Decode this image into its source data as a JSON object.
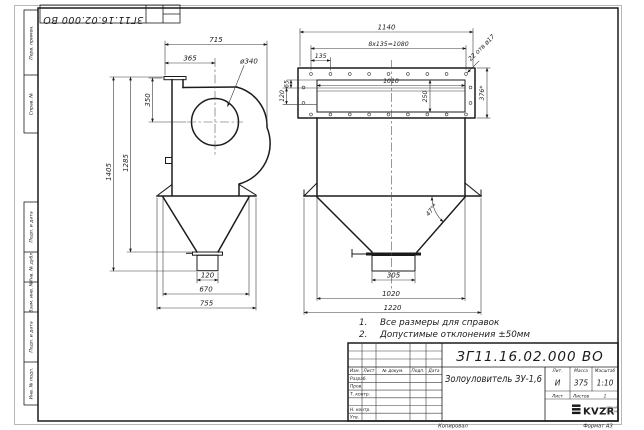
{
  "stamps": {
    "top_doc_number": "ЗГ11.16.02.000 ВО",
    "side": {
      "c1": "Перв. примен.",
      "c2": "Справ. №",
      "c3": "Подп. и дата",
      "c4": "Инв. № дубл.",
      "c5": "Взам. инв. №",
      "c6": "Подп. и дата",
      "c7": "Инв. № подл."
    }
  },
  "dims": {
    "side": {
      "w715": "715",
      "w365": "365",
      "dia340": "ø340",
      "h350": "350",
      "h1405": "1405",
      "h1285": "1285",
      "w120": "120",
      "w670": "670",
      "w755": "755"
    },
    "front": {
      "w1140": "1140",
      "pitch": "8x135=1080",
      "w135": "135",
      "holes": "22 отв ø17",
      "h376": "376*",
      "h65": "65",
      "h120": "120",
      "w1010": "1010",
      "h250": "250",
      "angle": "47°*",
      "w305": "305",
      "w1020": "1020",
      "w1220": "1220"
    }
  },
  "notes": {
    "n1_num": "1.",
    "n1_text": "Все размеры для справок",
    "n2_num": "2.",
    "n2_text": "Допустимые отклонения ±50мм"
  },
  "title_block": {
    "doc_number": "ЗГ11.16.02.000 ВО",
    "product_name": "Золоуловитель ЗУ-1,6",
    "header_cols": {
      "izm": "Изм.",
      "list": "Лист",
      "doc": "№ докум.",
      "podp": "Подп.",
      "data": "Дата"
    },
    "sign_rows": {
      "r1": "Разраб.",
      "r2": "Пров.",
      "r3": "Т. контр.",
      "r4": "Н. контр.",
      "r5": "Утв."
    },
    "lit": {
      "label": "Лит.",
      "value": "И"
    },
    "mass": {
      "label": "Масса",
      "value": "375"
    },
    "scale": {
      "label": "Масштаб",
      "value": "1:10"
    },
    "sheet": {
      "list_label": "Лист",
      "listov_label": "Листов",
      "listov_value": "1"
    },
    "org": {
      "logo": "KVZR",
      "line1": "КОТЕЛЬНЫЙ",
      "line2": "ЗАВОД РФ"
    },
    "footer": {
      "kopiroval": "Копировал",
      "format": "Формат A3"
    }
  }
}
